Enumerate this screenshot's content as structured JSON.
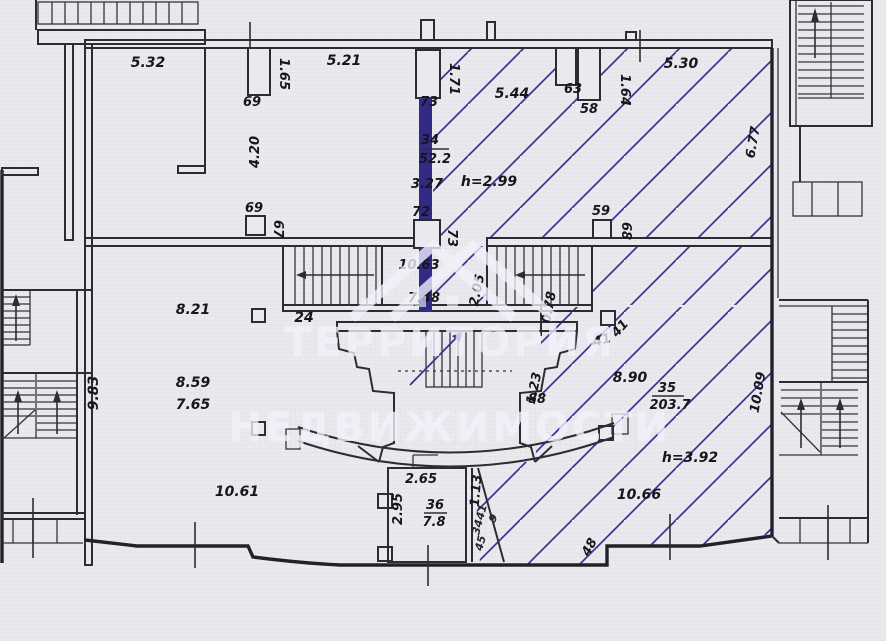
{
  "document": {
    "kind": "scanned architectural floor plan",
    "hatch_color": "#3a3590",
    "accent_wall_color": "#322b86",
    "paper_color": "#eaeaee"
  },
  "watermark": {
    "line1": "ТЕРРИТОРИЯ",
    "line2": "НЕДВИЖИМОСТИ"
  },
  "rooms": [
    {
      "number": "34",
      "area": "52.2"
    },
    {
      "number": "35",
      "area": "203.7"
    },
    {
      "number": "36",
      "area": "7.8"
    }
  ],
  "heights": [
    "h=2.99",
    "h=3.92"
  ],
  "labels": {
    "d532": "5.32",
    "d165": "1.65",
    "p69": "69",
    "d521": "5.21",
    "d171": "1.71",
    "c73t": "73",
    "d544": "5.44",
    "p63": "63",
    "p58": "58",
    "d164": "1.64",
    "d530": "5.30",
    "d677": "6.77",
    "d420": "4.20",
    "r34n": "34",
    "r34a": "52.2",
    "d327": "3.27",
    "h299": "h=2.99",
    "c72": "72",
    "c73m": "73",
    "c69": "69",
    "c67": "67",
    "c59": "59",
    "c68": "68",
    "d1063": "10.63",
    "d205": "2.05",
    "d748": "7.48",
    "c24": "24",
    "d078": "0.78",
    "r821": "8.21",
    "c41a": "41",
    "c41b": "41",
    "r859": "8.59",
    "r765": "7.65",
    "r890": "8.90",
    "r35n": "35",
    "r35a": "203.7",
    "d1009": "10.09",
    "d123": "1.23",
    "d88": "88",
    "d983": "9.83",
    "r1061": "10.61",
    "d265": "2.65",
    "d295": "2.95",
    "r36n": "36",
    "r36a": "7.8",
    "d113": "1.13",
    "d41s": "41",
    "d34s": "34",
    "d45s": "45",
    "d9s": "9",
    "h392": "h=3.92",
    "r1066": "10.66",
    "d48": "48"
  }
}
